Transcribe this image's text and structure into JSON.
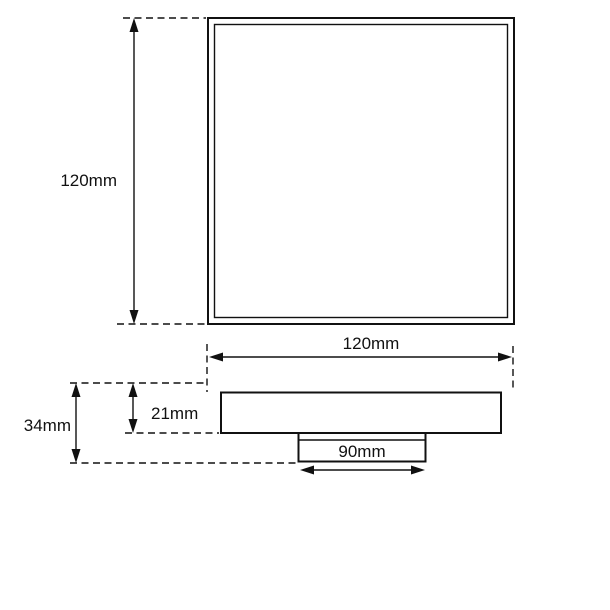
{
  "drawing": {
    "type": "technical-dimension-drawing",
    "views": {
      "plan_view": {
        "description": "square top view with double border",
        "labels": {
          "height": "120mm",
          "width": "120mm"
        }
      },
      "side_view": {
        "description": "profile with flange body and bottom outlet spigot",
        "labels": {
          "overall_height": "34mm",
          "body_height": "21mm",
          "outlet_width": "90mm"
        }
      }
    },
    "colors": {
      "line": "#111111",
      "background": "#ffffff"
    }
  }
}
